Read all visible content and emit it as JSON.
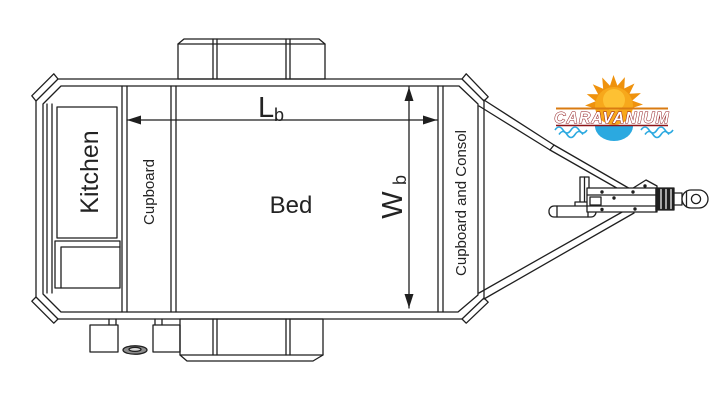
{
  "plan": {
    "line_color": "#1f1f1f",
    "labels": {
      "kitchen": "Kitchen",
      "cupboard": "Cupboard",
      "bed": "Bed",
      "cupboard_consol": "Cupboard and Consol"
    },
    "dimensions": {
      "length_symbol": "L",
      "length_subscript": "b",
      "width_symbol": "W",
      "width_subscript": "b"
    }
  },
  "logo": {
    "brand": "CARAVANIUM",
    "colors": {
      "rays": "#EF920D",
      "sun": "#F7A81B",
      "sun_highlight": "#FFC93C",
      "top_line": "#D97B12",
      "underline": "#8E1518",
      "water": "#2BA9E0",
      "text_stroke": "#8E1518",
      "text_fill": "#FFFFFF"
    }
  }
}
